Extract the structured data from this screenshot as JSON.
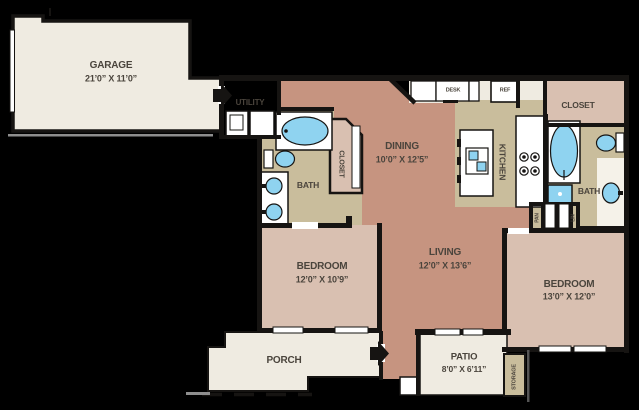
{
  "floorplan": {
    "rooms": {
      "garage": {
        "label": "GARAGE",
        "dims": "21’0” X 11’0”"
      },
      "dining": {
        "label": "DINING",
        "dims": "10’0” X 12’5”"
      },
      "living": {
        "label": "LIVING",
        "dims": "12’0” X 13’6”"
      },
      "bedroom_left": {
        "label": "BEDROOM",
        "dims": "12’0” X 10’9”"
      },
      "bedroom_right": {
        "label": "BEDROOM",
        "dims": "13’0” X 12’0”"
      },
      "patio": {
        "label": "PATIO",
        "dims": "8’0” X 6’11”"
      },
      "porch": {
        "label": "PORCH"
      },
      "utility": {
        "label": "UTILITY"
      },
      "kitchen": {
        "label": "KITCHEN"
      },
      "bath_left": {
        "label": "BATH"
      },
      "bath_right": {
        "label": "BATH"
      },
      "closet_left": {
        "label": "CLOSET"
      },
      "closet_right": {
        "label": "CLOSET"
      },
      "pantry": {
        "label": "PAN"
      },
      "linen": {
        "label": "LIN"
      },
      "storage": {
        "label": "STORAGE"
      }
    },
    "appliances": {
      "desk": "DESK",
      "refrigerator": "REF"
    },
    "icons": {
      "entry_arrows": "entry-arrow-icon",
      "fixtures": [
        "bathtub-icon",
        "toilet-icon",
        "sink-icon",
        "washer-icon",
        "dryer-icon",
        "stove-icon",
        "kitchen-sink-icon"
      ]
    },
    "colors": {
      "background": "#000000",
      "outdoor": "#EFEBE1",
      "wet": "#C9BD9C",
      "living": "#C69480",
      "bedroom": "#D9C0B1",
      "fixture": "#8FD3F0",
      "wall": "#161412",
      "text": "#4A443C",
      "window": "#FFFFFF",
      "driveway": "#8E8E8E",
      "alcove": "#F5F2E9"
    }
  }
}
